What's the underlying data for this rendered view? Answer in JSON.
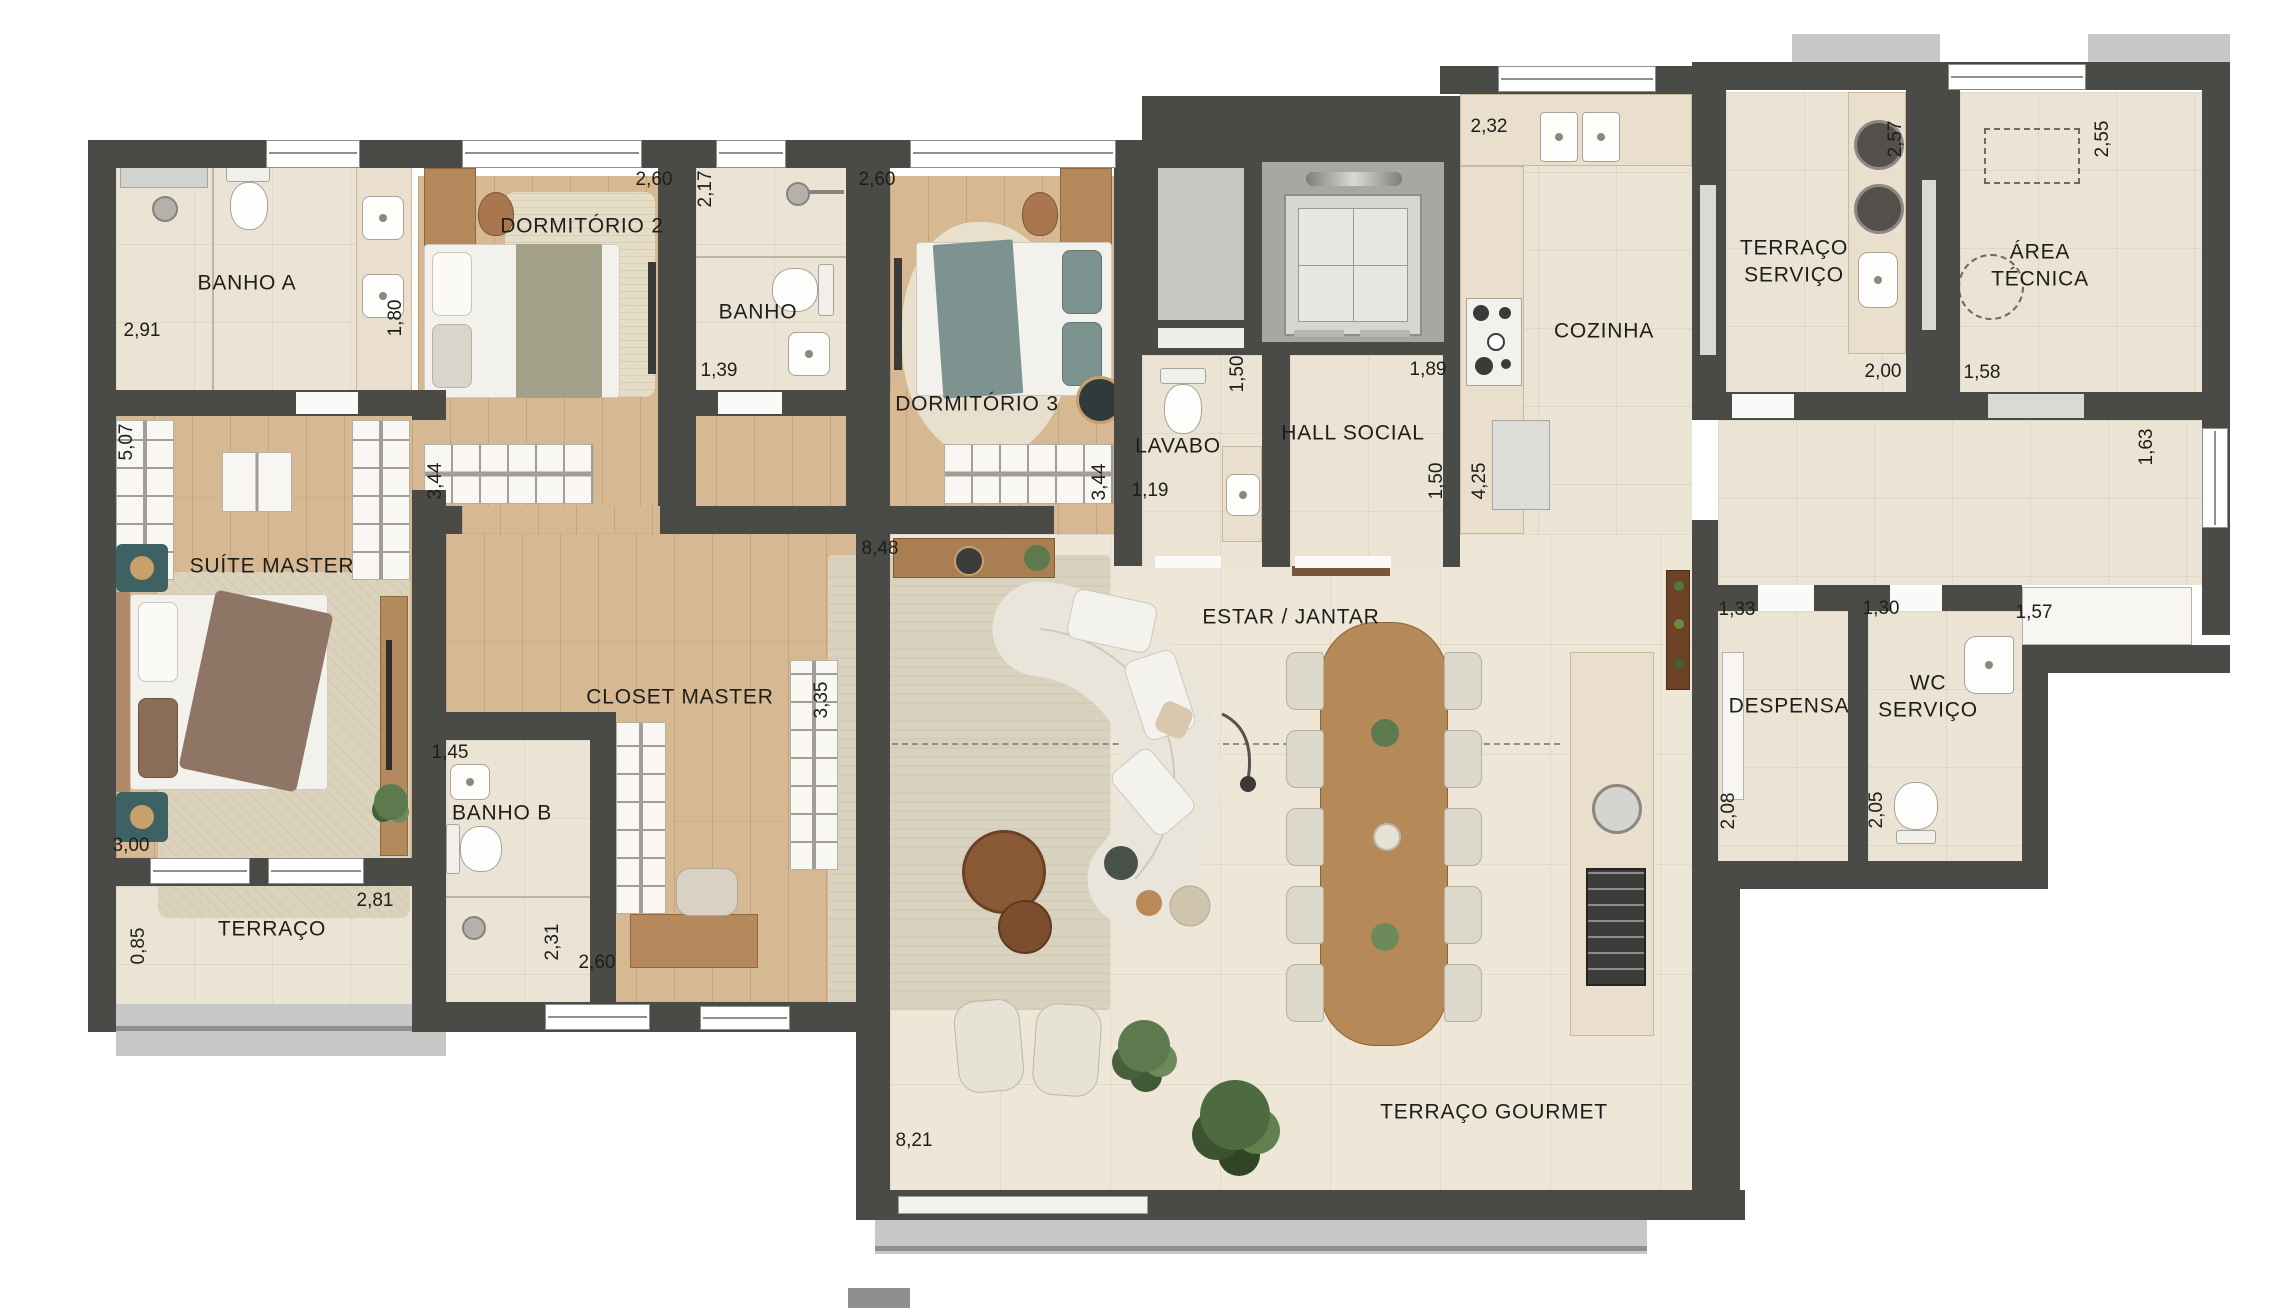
{
  "plan": {
    "rooms": {
      "banho_a": "BANHO A",
      "dormitorio_2": "DORMITÓRIO 2",
      "banho": "BANHO",
      "dormitorio_3": "DORMITÓRIO 3",
      "lavabo": "LAVABO",
      "hall_social": "HALL SOCIAL",
      "cozinha": "COZINHA",
      "terraco_servico": "TERRAÇO\nSERVIÇO",
      "area_tecnica": "ÁREA\nTÉCNICA",
      "suite_master": "SUÍTE MASTER",
      "closet_master": "CLOSET MASTER",
      "banho_b": "BANHO B",
      "terraco": "TERRAÇO",
      "estar_jantar": "ESTAR / JANTAR",
      "despensa": "DESPENSA",
      "wc_servico": "WC\nSERVIÇO",
      "terraco_gourmet": "TERRAÇO GOURMET"
    },
    "dimensions": {
      "banho_a_w": "2,91",
      "banho_a_h": "1,80",
      "dorm2_w": "2,60",
      "dorm2_ward": "3,44",
      "banho_h": "2,17",
      "banho_w": "1,39",
      "dorm3_w": "2,60",
      "dorm3_ward": "3,44",
      "cozinha_w": "2,32",
      "cozinha_l": "4,25",
      "lavabo_w": "1,19",
      "lavabo_h": "1,50",
      "hall_w": "1,89",
      "hall_h": "1,50",
      "servico_h": "2,57",
      "servico_w": "2,00",
      "tecnica_h": "2,55",
      "tecnica_w": "1,58",
      "corredor_janela": "1,63",
      "prateleira": "1,57",
      "despensa_w": "1,33",
      "despensa_h": "2,08",
      "wc_w": "1,30",
      "wc_h": "2,05",
      "suite_ward": "5,07",
      "suite_w": "3,00",
      "terraco_w": "2,81",
      "terraco_h": "0,85",
      "banho_b_w": "1,45",
      "banho_b_h": "2,31",
      "closet_w": "2,60",
      "closet_ward": "3,35",
      "estar_w": "8,48",
      "gourmet_w": "8,21"
    },
    "palette": {
      "wall": "#4a4a47",
      "wood_floor": "#d6b992",
      "tile_floor": "#ebe3d3",
      "slab": "#c7c7c5",
      "accent_teal": "#3e6263"
    }
  }
}
